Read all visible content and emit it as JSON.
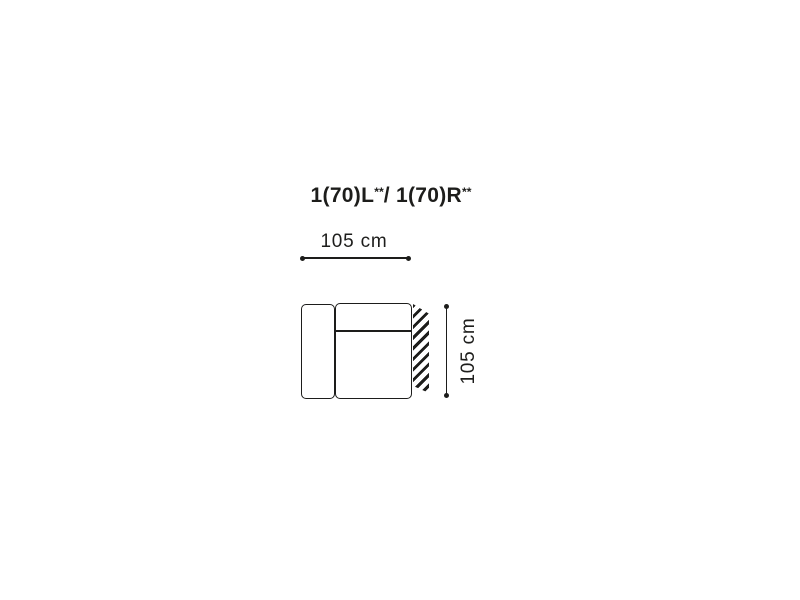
{
  "diagram": {
    "title": {
      "part1": "1(70)L",
      "sup1": "**",
      "part2": "/ 1(70)R",
      "sup2": "**"
    },
    "width_dimension": {
      "label": "105 cm"
    },
    "height_dimension": {
      "label": "105 cm"
    },
    "colors": {
      "line": "#1d1d1b",
      "text": "#1d1d1b",
      "background": "#ffffff"
    }
  }
}
